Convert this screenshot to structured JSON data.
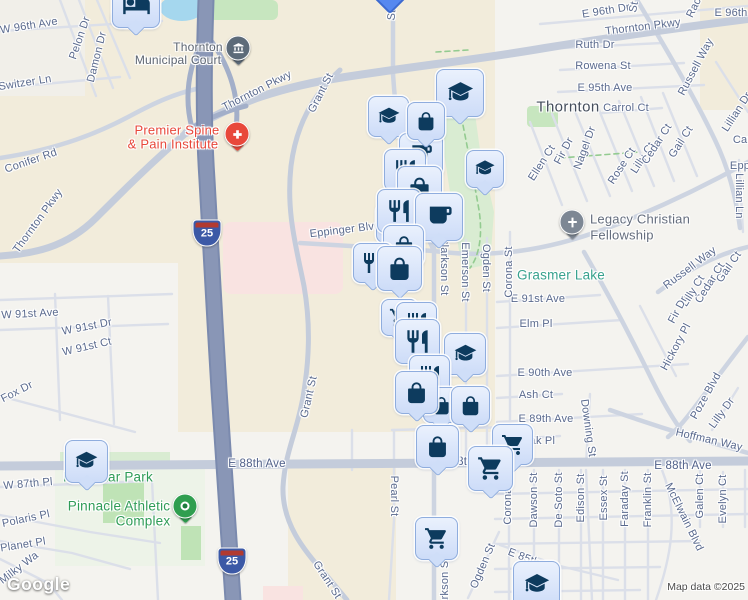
{
  "map": {
    "google_logo": "Google",
    "attribution": "Map data ©2025",
    "city": "Thornton",
    "colors": {
      "pin_fill": "#dbe6fa",
      "pin_border": "#8fadde",
      "pin_icon": "#0d3b5e",
      "road_major": "#c4ccdb",
      "highway": "#8996b6",
      "beige_area": "#f2ecdb",
      "park_green": "#c7e6bf",
      "water": "#a5d7ee",
      "label_street": "#5a6a8e",
      "label_green": "#2f9c57",
      "label_teal": "#38a28e",
      "label_red": "#e8483b",
      "label_poi_grey": "#5d6571",
      "label_city": "#454e5c",
      "marker_court": "#5d6b79",
      "marker_medical": "#e8483b",
      "marker_church": "#7d8794",
      "marker_park": "#2f9e4f",
      "shield_blue": "#3c59a6",
      "shield_red": "#b23a30"
    },
    "labels": [
      {
        "t": "W 96th Ave",
        "x": 29,
        "y": 26,
        "r": -9
      },
      {
        "t": "Pelon Dr",
        "x": 80,
        "y": 38,
        "r": -71
      },
      {
        "t": "Damon Dr",
        "x": 97,
        "y": 57,
        "r": -76
      },
      {
        "t": "Switzer Ln",
        "x": 25,
        "y": 83,
        "r": -9
      },
      {
        "t": "Thornton",
        "x": 198,
        "y": 47,
        "k": "poi"
      },
      {
        "t": "Municipal Court",
        "x": 178,
        "y": 60,
        "k": "poi"
      },
      {
        "t": "Thornton Pkwy",
        "x": 257,
        "y": 91,
        "r": -27
      },
      {
        "t": "Grant St",
        "x": 321,
        "y": 93,
        "r": -63
      },
      {
        "t": "Conifer Rd",
        "x": 31,
        "y": 161,
        "r": -19
      },
      {
        "t": "Thornton Pkwy",
        "x": 38,
        "y": 221,
        "r": -54
      },
      {
        "t": "Premier Spine",
        "x": 177,
        "y": 130,
        "k": "red"
      },
      {
        "t": "& Pain Institute",
        "x": 173,
        "y": 144,
        "k": "red"
      },
      {
        "t": "E 96th Dr",
        "x": 606,
        "y": 11,
        "r": -9
      },
      {
        "t": "E 96th",
        "x": 731,
        "y": 13
      },
      {
        "t": "Rac",
        "x": 694,
        "y": 8,
        "r": -64
      },
      {
        "t": "St",
        "x": 634,
        "y": 7,
        "r": -80
      },
      {
        "t": "St",
        "x": 392,
        "y": 15,
        "r": -85
      },
      {
        "t": "Thornton Pkwy",
        "x": 643,
        "y": 27,
        "r": -7
      },
      {
        "t": "Ruth Dr",
        "x": 595,
        "y": 45
      },
      {
        "t": "Rowena St",
        "x": 603,
        "y": 66
      },
      {
        "t": "E 95th Ave",
        "x": 605,
        "y": 88
      },
      {
        "t": "Thornton",
        "x": 568,
        "y": 107,
        "k": "city"
      },
      {
        "t": "Carrol Ct",
        "x": 626,
        "y": 108
      },
      {
        "t": "Russell Way",
        "x": 696,
        "y": 67,
        "r": -62
      },
      {
        "t": "Lillian Dr",
        "x": 737,
        "y": 112,
        "r": -57
      },
      {
        "t": "Car",
        "x": 742,
        "y": 140
      },
      {
        "t": "Ellen Ct",
        "x": 542,
        "y": 163,
        "r": -57
      },
      {
        "t": "Fir Dr",
        "x": 564,
        "y": 151,
        "r": -62
      },
      {
        "t": "Nagel Dr",
        "x": 585,
        "y": 148,
        "r": -70
      },
      {
        "t": "Rose Ct",
        "x": 622,
        "y": 166,
        "r": -57
      },
      {
        "t": "Lilly Ct",
        "x": 643,
        "y": 158,
        "r": -57
      },
      {
        "t": "Cedar Ct",
        "x": 657,
        "y": 144,
        "r": -57
      },
      {
        "t": "Gail Ct",
        "x": 681,
        "y": 142,
        "r": -57
      },
      {
        "t": "Epp",
        "x": 740,
        "y": 166
      },
      {
        "t": "Lillian Ln",
        "x": 739,
        "y": 196,
        "r": 90
      },
      {
        "t": "Legacy Christian",
        "x": 640,
        "y": 219,
        "k": "poi13"
      },
      {
        "t": "Fellowship",
        "x": 622,
        "y": 235,
        "k": "poi13"
      },
      {
        "t": "Grasmer Lake",
        "x": 561,
        "y": 275,
        "k": "teal"
      },
      {
        "t": "Russell Way",
        "x": 690,
        "y": 268,
        "r": -37
      },
      {
        "t": "Gail Ct",
        "x": 729,
        "y": 267,
        "r": -55
      },
      {
        "t": "Cedar Ct",
        "x": 710,
        "y": 283,
        "r": -58
      },
      {
        "t": "Lilly Ct",
        "x": 693,
        "y": 291,
        "r": -58
      },
      {
        "t": "Fir Dr",
        "x": 678,
        "y": 310,
        "r": -62
      },
      {
        "t": "Hickory Pl",
        "x": 676,
        "y": 347,
        "r": -62
      },
      {
        "t": "E 91st Ave",
        "x": 538,
        "y": 299
      },
      {
        "t": "Elm Pl",
        "x": 536,
        "y": 324
      },
      {
        "t": "E 90th Ave",
        "x": 545,
        "y": 373
      },
      {
        "t": "Ash Ct",
        "x": 536,
        "y": 395
      },
      {
        "t": "Corona St",
        "x": 509,
        "y": 272,
        "r": -90
      },
      {
        "t": "Clarkson St",
        "x": 444,
        "y": 266,
        "r": 90
      },
      {
        "t": "Emerson St",
        "x": 465,
        "y": 272,
        "r": 90
      },
      {
        "t": "Ogden St",
        "x": 486,
        "y": 268,
        "r": 90
      },
      {
        "t": "Eppinger Blvd",
        "x": 345,
        "y": 230,
        "r": -7
      },
      {
        "t": "W 91st Ave",
        "x": 30,
        "y": 314,
        "r": -3
      },
      {
        "t": "W 91st Dr",
        "x": 87,
        "y": 327,
        "r": -11
      },
      {
        "t": "W 91st Ct",
        "x": 87,
        "y": 347,
        "r": -13
      },
      {
        "t": "Fox Dr",
        "x": 17,
        "y": 392,
        "r": -27
      },
      {
        "t": "Grant St",
        "x": 309,
        "y": 397,
        "r": -77
      },
      {
        "t": "E 89th Ave",
        "x": 546,
        "y": 419
      },
      {
        "t": "Downing St",
        "x": 588,
        "y": 428,
        "r": 82
      },
      {
        "t": "Poze Blvd",
        "x": 706,
        "y": 396,
        "r": -61
      },
      {
        "t": "Lilly Dr",
        "x": 722,
        "y": 413,
        "r": -54
      },
      {
        "t": "Hoffman Way",
        "x": 709,
        "y": 440,
        "r": 13
      },
      {
        "t": "E 88th Ave",
        "x": 683,
        "y": 466,
        "k": "ave"
      },
      {
        "t": "E 88th Ave",
        "x": 257,
        "y": 464,
        "k": "ave"
      },
      {
        "t": "E 88th Ave",
        "x": 468,
        "y": 462,
        "k": "ave"
      },
      {
        "t": "Oak Pl",
        "x": 538,
        "y": 441
      },
      {
        "t": "Essex St",
        "x": 604,
        "y": 498,
        "r": -90
      },
      {
        "t": "Faraday St",
        "x": 625,
        "y": 499,
        "r": -90
      },
      {
        "t": "Franklin St",
        "x": 648,
        "y": 500,
        "r": -90
      },
      {
        "t": "McElwain Blvd",
        "x": 684,
        "y": 517,
        "r": 64
      },
      {
        "t": "Galen Ct",
        "x": 700,
        "y": 496,
        "r": -90
      },
      {
        "t": "Evelyn Ct",
        "x": 723,
        "y": 499,
        "r": -90
      },
      {
        "t": "Dawson St",
        "x": 534,
        "y": 500,
        "r": -90
      },
      {
        "t": "De Soto St",
        "x": 559,
        "y": 500,
        "r": -90
      },
      {
        "t": "Edison St",
        "x": 581,
        "y": 498,
        "r": -90
      },
      {
        "t": "Corona St",
        "x": 508,
        "y": 499,
        "r": -90
      },
      {
        "t": "Ogden St",
        "x": 483,
        "y": 566,
        "r": -67
      },
      {
        "t": "Clarkson St",
        "x": 445,
        "y": 587,
        "r": -90
      },
      {
        "t": "Pearl St",
        "x": 394,
        "y": 496,
        "r": 90
      },
      {
        "t": "Grant St",
        "x": 327,
        "y": 580,
        "r": 57
      },
      {
        "t": "W 87th Pl",
        "x": 28,
        "y": 484,
        "r": -5
      },
      {
        "t": "Polaris Pl",
        "x": 26,
        "y": 519,
        "r": -12
      },
      {
        "t": "Planet Pl",
        "x": 23,
        "y": 545,
        "r": -9
      },
      {
        "t": "Milky Wa",
        "x": 19,
        "y": 568,
        "r": -37
      },
      {
        "t": "Northstar Park",
        "x": 108,
        "y": 477,
        "k": "green"
      },
      {
        "t": "Pinnacle Athletic",
        "x": 119,
        "y": 506,
        "k": "green"
      },
      {
        "t": "Complex",
        "x": 143,
        "y": 521,
        "k": "green"
      },
      {
        "t": "E 85th Pl",
        "x": 530,
        "y": 560,
        "r": 21
      }
    ],
    "pins": [
      {
        "icon": "lodging",
        "x": 112,
        "y": -20,
        "w": 46
      },
      {
        "icon": "graduation",
        "x": 368,
        "y": 96,
        "w": 39
      },
      {
        "icon": "graduation",
        "x": 436,
        "y": 69,
        "w": 46
      },
      {
        "icon": "cafe",
        "x": 399,
        "y": 133,
        "w": 42
      },
      {
        "icon": "bag",
        "x": 407,
        "y": 102,
        "w": 36
      },
      {
        "icon": "restaurant",
        "x": 384,
        "y": 149,
        "w": 40
      },
      {
        "icon": "bag",
        "x": 397,
        "y": 166,
        "w": 43
      },
      {
        "icon": "cart",
        "x": 376,
        "y": 203,
        "w": 38
      },
      {
        "icon": "restaurant",
        "x": 377,
        "y": 189,
        "w": 42
      },
      {
        "icon": "cafe",
        "x": 415,
        "y": 193,
        "w": 46
      },
      {
        "icon": "graduation",
        "x": 466,
        "y": 150,
        "w": 36
      },
      {
        "icon": "bag",
        "x": 383,
        "y": 225,
        "w": 39
      },
      {
        "icon": "restaurant",
        "x": 353,
        "y": 243,
        "w": 38
      },
      {
        "icon": "bag",
        "x": 377,
        "y": 246,
        "w": 43
      },
      {
        "icon": "cart",
        "x": 381,
        "y": 299,
        "w": 35
      },
      {
        "icon": "restaurant",
        "x": 396,
        "y": 302,
        "w": 39
      },
      {
        "icon": "restaurant",
        "x": 395,
        "y": 319,
        "w": 43
      },
      {
        "icon": "graduation",
        "x": 444,
        "y": 333,
        "w": 40
      },
      {
        "icon": "restaurant",
        "x": 409,
        "y": 355,
        "w": 39
      },
      {
        "icon": "bag",
        "x": 423,
        "y": 387,
        "w": 34
      },
      {
        "icon": "bag",
        "x": 451,
        "y": 386,
        "w": 37
      },
      {
        "icon": "bag",
        "x": 395,
        "y": 371,
        "w": 41
      },
      {
        "icon": "bag",
        "x": 416,
        "y": 425,
        "w": 41
      },
      {
        "icon": "cart",
        "x": 492,
        "y": 424,
        "w": 39
      },
      {
        "icon": "cart",
        "x": 468,
        "y": 446,
        "w": 43
      },
      {
        "icon": "cart",
        "x": 415,
        "y": 517,
        "w": 41
      },
      {
        "icon": "graduation",
        "x": 513,
        "y": 561,
        "w": 45
      },
      {
        "icon": "graduation",
        "x": 65,
        "y": 440,
        "w": 41
      }
    ],
    "markers": [
      {
        "kind": "poi",
        "icon": "court",
        "name": "municipal-court-marker",
        "color": "#5d6b79",
        "x": 238,
        "y": 48
      },
      {
        "kind": "poi",
        "icon": "plus",
        "name": "medical-marker",
        "color": "#e8483b",
        "x": 237,
        "y": 134
      },
      {
        "kind": "poi",
        "icon": "cross",
        "name": "church-marker",
        "color": "#7d8794",
        "x": 572,
        "y": 222
      },
      {
        "kind": "park",
        "name": "park-marker",
        "color": "#2f9e4f",
        "x": 185,
        "y": 506
      },
      {
        "kind": "shield",
        "name": "interstate-25-shield",
        "num": "25",
        "x": 207,
        "y": 233
      },
      {
        "kind": "shield",
        "name": "interstate-25-shield",
        "num": "25",
        "x": 232,
        "y": 561
      },
      {
        "kind": "diamond",
        "name": "transit-pin-tip",
        "x": 390,
        "y": -2
      },
      {
        "kind": "dot",
        "name": "collapsed-poi-marker",
        "x": 122,
        "y": 17
      }
    ],
    "icons": {
      "graduation": "M12 2.6 1.6 7.9 12 13.2 22.4 7.9 12 2.6ZM5.4 10.8v3.7c0 1.8 3 3.3 6.6 3.3s6.6-1.5 6.6-3.3v-3.7L12 14.1 5.4 10.8ZM2.7 8.9h1.5v5.9c0 .3-.3.6-.75.6s-.75-.3-.75-.6V8.9ZM2.3 16.3a1.15 1.15 0 1 0 2.3 0 1.15 1.15 0 1 0-2.3 0Z",
      "bag": "M12 2.3c-2.6 0-4.7 2.1-4.7 4.7v1.2H4.8c-.5 0-.9.4-.9.9V19c0 1.8 1.4 3.2 3.2 3.2h9.8c1.8 0 3.2-1.4 3.2-3.2V9.1c0-.5-.4-.9-.9-.9h-2.5V7c0-2.6-2.1-4.7-4.7-4.7ZM9.1 8.2V7c0-1.6 1.3-2.9 2.9-2.9s2.9 1.3 2.9 2.9v1.2H9.1Z",
      "restaurant": "M11 9H9V2H7v7H5V2H3v7c0 2.12 1.66 3.84 3.75 3.97V22h2.5v-9.03C11.34 12.84 13 11.12 13 9V2h-2v7zm5-3v8h2.5v8H21V2c-2.76 0-5 2.24-5 4z",
      "cafe": "M20 3H4v10c0 2.21 1.79 4 4 4h6c2.21 0 4-1.79 4-4v-3h2c1.11 0 2-.89 2-2V5c0-1.11-.89-2-2-2zm0 5h-2V5h2v3z",
      "cart": "M7 18c-1.1 0-1.99.9-1.99 2S5.9 22 7 22s2-.9 2-2-.9-2-2-2zM1 2v2h2l3.6 7.59-1.35 2.45c-.16.28-.25.61-.25.96 0 1.1.9 2 2 2h12v-2H7.42c-.14 0-.25-.11-.25-.25l.03-.12.9-1.63h7.45c.75 0 1.41-.41 1.75-1.03l3.58-6.49c.08-.14.12-.31.12-.47 0-.55-.45-1-1-1H5.21l-.94-2H1zm16 16c-1.1 0-1.99.9-1.99 2s.89 2 1.99 2 2-.9 2-2-.9-2-2-2z",
      "lodging": "M7 13c1.66 0 3-1.34 3-3S8.66 7 7 7s-3 1.34-3 3 1.34 3 3 3zm13-6h-9v7H3V5H1v15h2v-3h18v3h2v-9c0-2.21-1.79-4-4-4z",
      "court": "M12 2.7 3.4 6.8v1.8h17.2V6.8L12 2.7ZM4.8 10v5.6h2.5V10H4.8Zm5.95 0v5.6h2.5V10h-2.5ZM16.7 10v5.6h2.5V10h-2.5ZM3.4 17.3V20h17.2v-2.7H3.4Z",
      "cross": "M10.3 3.6h3.4v5.8h5.7v3.4h-5.7v7.6h-3.4v-7.6H4.6V9.4h5.7V3.6Z",
      "plus": "M9.7 4.8h4.6v4.9h4.9v4.6h-4.9V19H9.7v-4.7H4.8V9.7h4.9V4.8Z"
    }
  }
}
